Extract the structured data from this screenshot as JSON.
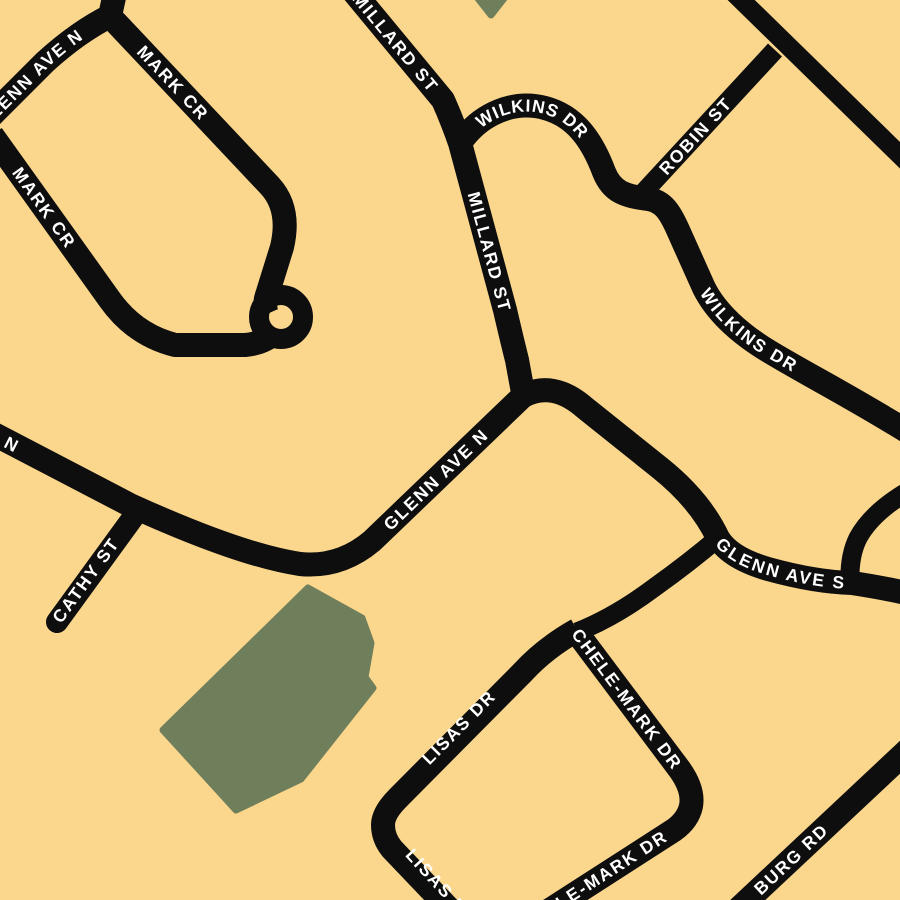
{
  "map": {
    "canvas": {
      "width": 900,
      "height": 900
    },
    "colors": {
      "background": "#FBD78D",
      "road": "#0E0E0E",
      "park": "#6F7E5B",
      "label_text": "#FFFFFF"
    },
    "label_style": {
      "font_size": 17.5,
      "letter_spacing": 1.8,
      "font_weight": 700
    },
    "parks": [
      {
        "id": "park-north-small",
        "points": "473,-8 491,15 509,-8"
      },
      {
        "id": "park-central",
        "points": "308,588 362,618 371,643 365,677 373,688 301,779 236,810 163,730"
      }
    ],
    "roads": [
      {
        "id": "glenn-ave-n-top",
        "d": "M -25,132 L 45,62 Q 78,32 110,16 L 116,-12",
        "width": 24
      },
      {
        "id": "mark-cr-upper",
        "d": "M 106,12 L 270,186 Q 291,209 282,247 L 268,292 Q 263,305 267,314",
        "width": 24
      },
      {
        "id": "mark-cr-lower",
        "d": "M -8,135 L 110,300 Q 135,335 175,345 L 245,345 Q 266,343 276,331",
        "width": 24
      },
      {
        "id": "mark-cr-loop",
        "d": "M 259,317 a 22,22 0 1 0 44,0 a 22,22 0 1 0 -44,0",
        "width": 20
      },
      {
        "id": "millard-st",
        "d": "M 352,-10 L 443,100 Q 452,120 460,143 L 505,310 Q 512,340 517,360 L 524,398",
        "width": 24
      },
      {
        "id": "wilkins-dr",
        "d": "M 458,146 C 480,112 515,100 545,108 C 575,116 592,140 604,172 C 612,192 625,196 648,199 C 663,201 670,212 678,230 L 704,288 C 716,312 740,334 770,352 C 810,376 850,396 908,432",
        "width": 24
      },
      {
        "id": "robin-st",
        "d": "M 642,194 L 775,50",
        "width": 19
      },
      {
        "id": "northeast-diagonal",
        "d": "M 733,-8 L 910,165",
        "width": 19
      },
      {
        "id": "glenn-ave-n",
        "d": "M -10,432 L 130,505 Q 240,555 300,564 Q 340,568 372,541 L 523,396",
        "width": 24
      },
      {
        "id": "glenn-ave-s",
        "d": "M 523,396 Q 553,380 585,408 L 660,468 Q 700,500 718,538 Q 730,558 768,569 Q 815,582 852,583 Q 885,588 910,594",
        "width": 24
      },
      {
        "id": "cathy-st",
        "d": "M 57,622 L 137,512",
        "width": 22,
        "cap": "round"
      },
      {
        "id": "glenn-connector-east",
        "d": "M 910,490 Q 872,512 858,538 Q 849,556 850,583",
        "width": 19
      },
      {
        "id": "lisas-connector",
        "d": "M 718,538 Q 690,562 655,587 Q 615,617 577,632",
        "width": 19
      },
      {
        "id": "lisas-dr",
        "d": "M 577,630 Q 545,648 523,672 L 398,798 Q 383,813 383,825 Q 383,838 392,849 L 455,915",
        "width": 24
      },
      {
        "id": "chele-mark-dr",
        "d": "M 575,630 L 680,770 Q 694,790 691,806 Q 688,820 674,830 L 542,915",
        "width": 24
      },
      {
        "id": "burg-rd",
        "d": "M 735,912 L 912,746",
        "width": 24
      }
    ],
    "labels": [
      {
        "id": "glenn-ave-n-top-label",
        "text": "GLENN AVE N",
        "path": "M -25,132 L 45,62 Q 78,32 112,14",
        "offset": 8
      },
      {
        "id": "mark-cr-upper-label",
        "text": "MARK CR",
        "path": "M 106,12 L 270,186",
        "offset": 50
      },
      {
        "id": "mark-cr-lower-label",
        "text": "MARK CR",
        "path": "M -8,135 L 110,300",
        "offset": 42
      },
      {
        "id": "millard-st-top-label",
        "text": "MILLARD ST",
        "path": "M 352,-10 L 443,100 Q 452,120 460,143 L 505,310 Q 512,340 517,360 L 524,398",
        "offset": 6
      },
      {
        "id": "millard-st-mid-label",
        "text": "MILLARD ST",
        "path": "M 352,-10 L 443,100 Q 452,120 460,143 L 505,310 Q 512,340 517,360 L 524,398",
        "offset": 240
      },
      {
        "id": "wilkins-dr-top-label",
        "text": "WILKINS DR",
        "path": "M 458,146 C 480,112 515,100 545,108 C 575,116 592,140 604,172 C 612,192 625,196 648,199 C 663,201 670,212 678,230 L 704,288 C 716,312 740,334 770,352 C 810,376 850,396 908,432",
        "offset": 30
      },
      {
        "id": "wilkins-dr-mid-label",
        "text": "WILKINS DR",
        "path": "M 458,146 C 480,112 515,100 545,108 C 575,116 592,140 604,172 C 612,192 625,196 648,199 C 663,201 670,212 678,230 L 704,288 C 716,312 740,334 770,352 C 810,376 850,396 908,432",
        "offset": 358
      },
      {
        "id": "robin-st-label",
        "text": "ROBIN ST",
        "path": "M 642,194 L 775,50",
        "offset": 30
      },
      {
        "id": "glenn-ave-n-mid-label",
        "text": "GLENN AVE N",
        "path": "M -10,432 L 130,505 Q 240,555 300,564 Q 340,568 372,541 L 523,396",
        "offset": 436
      },
      {
        "id": "glenn-ave-n-edge-label",
        "text": "GLENN AVE N",
        "path": "M -120,377 L 140,510",
        "offset": 18
      },
      {
        "id": "glenn-ave-s-label",
        "text": "GLENN AVE S",
        "path": "M 523,396 Q 553,380 585,408 L 660,468 Q 700,500 718,538 Q 730,558 768,569 Q 815,582 852,583 Q 885,588 910,594",
        "offset": 258
      },
      {
        "id": "cathy-st-label",
        "text": "CATHY ST",
        "path": "M 48,632 L 140,506",
        "offset": 14
      },
      {
        "id": "lisas-dr-label",
        "text": "LISAS DR",
        "path": "M 390,797 L 565,620",
        "offset": 50
      },
      {
        "id": "lisas-dr-bottom-label",
        "text": "LISAS DR",
        "path": "M 382,822 L 470,918",
        "offset": 40
      },
      {
        "id": "chele-mark-dr-label",
        "text": "CHELE-MARK DR",
        "path": "M 572,626 L 686,778",
        "offset": 6
      },
      {
        "id": "chele-mark-dr-bottom-label",
        "text": "CHELE-MARK DR",
        "path": "M 505,938 L 684,823",
        "offset": 20
      },
      {
        "id": "burg-rd-label",
        "text": "BURG RD",
        "path": "M 735,912 L 912,746",
        "offset": 30
      }
    ]
  }
}
